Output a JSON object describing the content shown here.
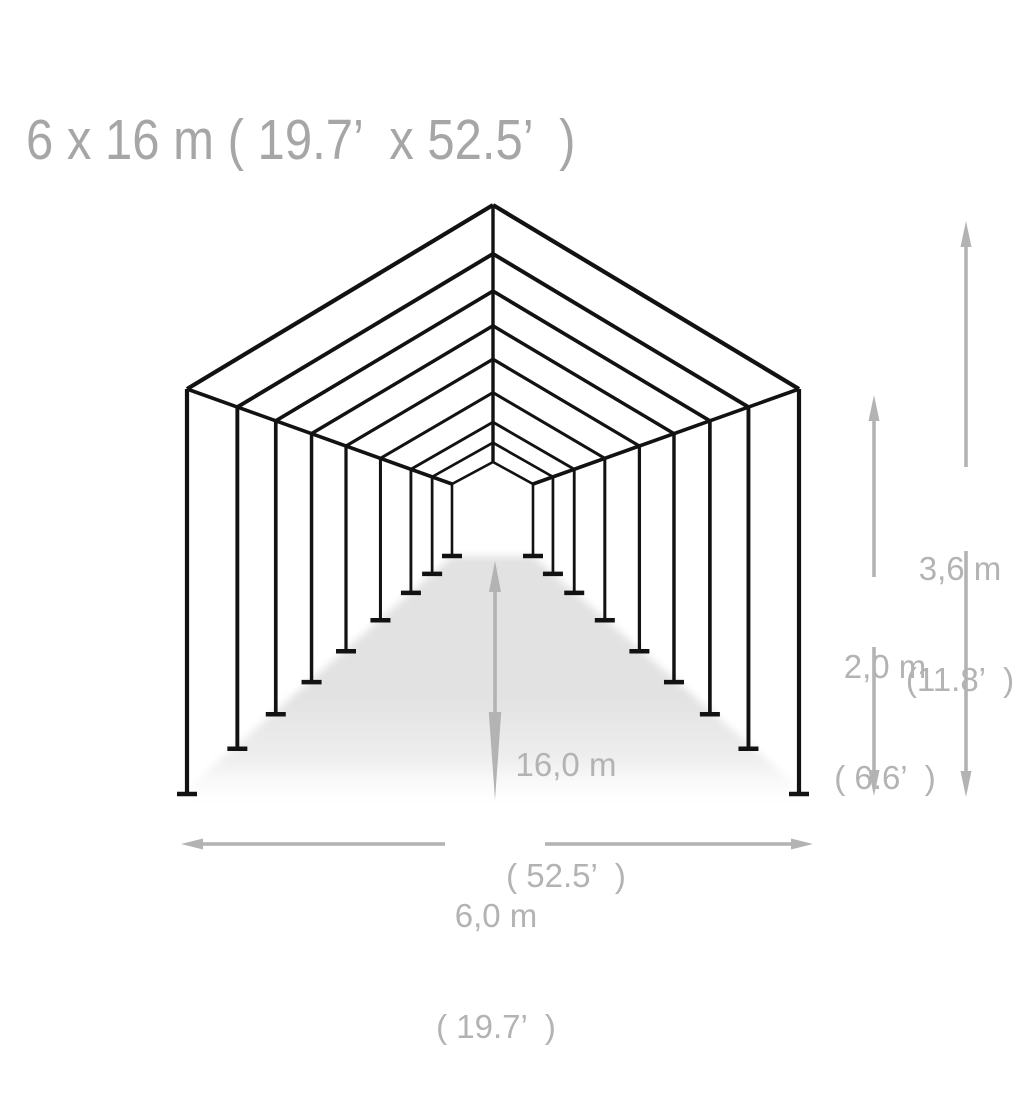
{
  "title": "6 x 16 m ( 19.7’  x 52.5’  )",
  "dimensions": {
    "total_height": {
      "metric": "3,6 m",
      "imperial": "(11.8’  )"
    },
    "side_height": {
      "metric": "2,0 m",
      "imperial": "( 6.6’  )"
    },
    "length": {
      "metric": "16,0 m",
      "imperial": "( 52.5’  )"
    },
    "width": {
      "metric": "6,0 m",
      "imperial": "( 19.7’  )"
    }
  },
  "diagram": {
    "type": "tent-wireframe-perspective",
    "frame_count": 9,
    "colors": {
      "frame": "#121212",
      "dimension": "#b3b3b3",
      "floor": "#e2e2e2",
      "title_text": "#a6a6a6",
      "label_text": "#b3b3b3",
      "background": "#ffffff"
    }
  }
}
